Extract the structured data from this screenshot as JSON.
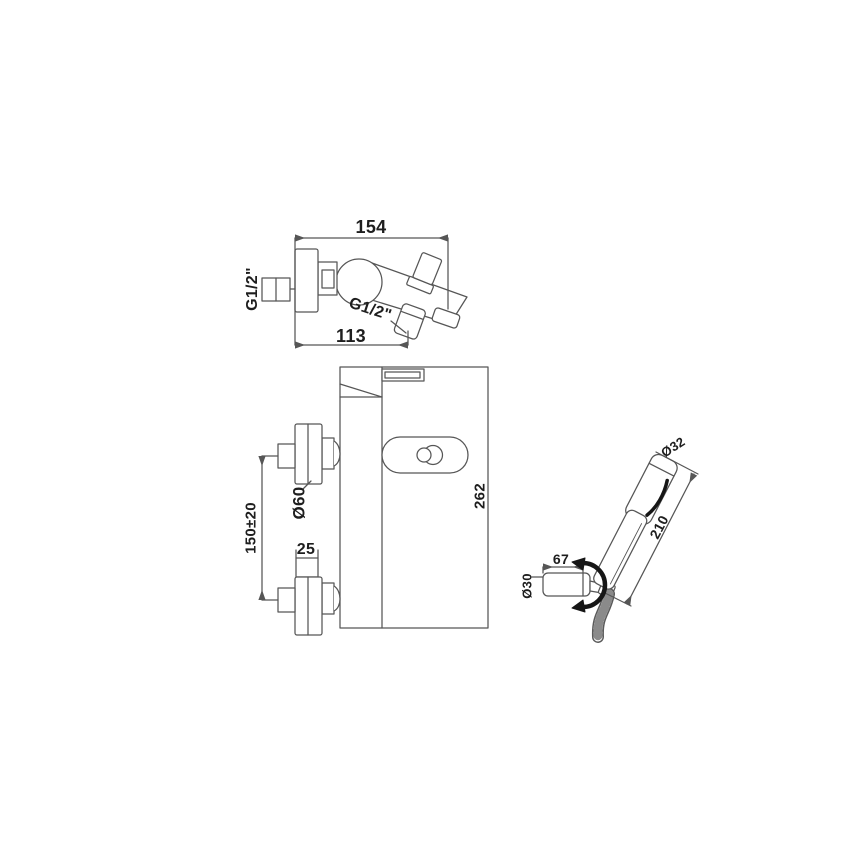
{
  "page": {
    "background": "#ffffff",
    "line_color": "#565656",
    "bold_detail_color": "#161616",
    "text_color": "#1e1e1e"
  },
  "top_view": {
    "overall_depth": "154",
    "spout_reach": "113",
    "inlet_thread": "G1/2\"",
    "outlet_thread": "G1/2\""
  },
  "front_view": {
    "overall_height": "262",
    "escutcheon_diameter": "Ø60",
    "inlet_spacing": "150±20",
    "escutcheon_depth": "25"
  },
  "hand_shower": {
    "head_diameter": "Ø32",
    "length": "210",
    "holder_length": "67",
    "holder_diameter": "Ø30"
  }
}
